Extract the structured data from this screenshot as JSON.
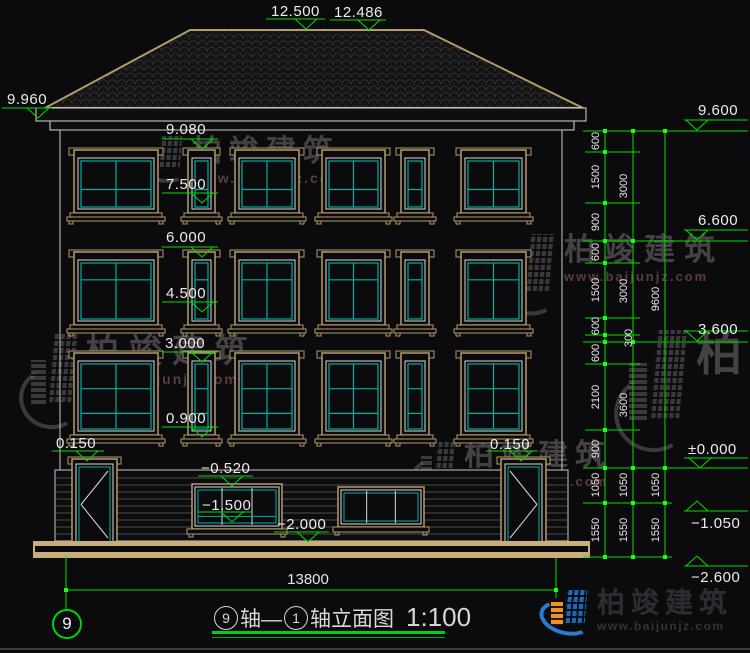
{
  "title_block": {
    "from_axis": "9",
    "mid_text": "轴—",
    "to_axis": "1",
    "suffix_text": "轴立面图",
    "scale": "1:100"
  },
  "axis_marker": "9",
  "bottom_dim": {
    "value": "13800"
  },
  "watermark_text": {
    "name": "柏竣建筑",
    "url": "www.baijunjz.com"
  },
  "logo": {
    "name": "柏竣建筑",
    "url": "www.baijunjz.com"
  },
  "colors": {
    "background": "#0b0b0e",
    "green": "#00dc00",
    "bright_green": "#19ff19",
    "tan": "#b49b6b",
    "ground_tan": "#c7ae7b",
    "teal": "#00b0a0",
    "white_line": "#d9d9d9",
    "text": "#ececec",
    "siding": "#4b4b4b",
    "logo_blue": "#1f66b5",
    "logo_orange": "#f0941f"
  },
  "drawing": {
    "roof": {
      "points": "45,108 190,30 424,30 583,108"
    },
    "eave_bands": [
      {
        "x": 36,
        "y": 108,
        "w": 550,
        "h": 13
      },
      {
        "x": 50,
        "y": 121,
        "w": 524,
        "h": 9
      }
    ],
    "wall": {
      "x": 60,
      "y": 130,
      "w": 502,
      "h": 340
    },
    "plinth": {
      "x": 55,
      "y": 470,
      "w": 513,
      "h": 71,
      "siding_start": 478,
      "siding_end": 538,
      "siding_gap": 7
    },
    "ground_bands": [
      {
        "x": 33,
        "y": 541,
        "w": 557,
        "h": 5
      },
      {
        "x": 33,
        "y": 552,
        "w": 557,
        "h": 6
      },
      {
        "x": 33,
        "y": 541,
        "w": 2,
        "h": 17
      },
      {
        "x": 588,
        "y": 541,
        "w": 2,
        "h": 17
      }
    ],
    "windows": [
      {
        "x": 74,
        "y": 150,
        "w": 84,
        "h": 63,
        "type": 1
      },
      {
        "x": 188,
        "y": 150,
        "w": 27,
        "h": 63,
        "type": 1
      },
      {
        "x": 235,
        "y": 150,
        "w": 64,
        "h": 63,
        "type": 1
      },
      {
        "x": 322,
        "y": 150,
        "w": 63,
        "h": 63,
        "type": 1
      },
      {
        "x": 401,
        "y": 150,
        "w": 28,
        "h": 63,
        "type": 1
      },
      {
        "x": 461,
        "y": 150,
        "w": 65,
        "h": 63,
        "type": 1
      },
      {
        "x": 74,
        "y": 252,
        "w": 84,
        "h": 73,
        "type": 2
      },
      {
        "x": 188,
        "y": 252,
        "w": 27,
        "h": 73,
        "type": 2
      },
      {
        "x": 235,
        "y": 252,
        "w": 64,
        "h": 73,
        "type": 2
      },
      {
        "x": 322,
        "y": 252,
        "w": 63,
        "h": 73,
        "type": 2
      },
      {
        "x": 401,
        "y": 252,
        "w": 28,
        "h": 73,
        "type": 2
      },
      {
        "x": 461,
        "y": 252,
        "w": 65,
        "h": 73,
        "type": 2
      },
      {
        "x": 74,
        "y": 353,
        "w": 84,
        "h": 82,
        "type": 3
      },
      {
        "x": 188,
        "y": 353,
        "w": 27,
        "h": 82,
        "type": 3
      },
      {
        "x": 235,
        "y": 353,
        "w": 64,
        "h": 82,
        "type": 3
      },
      {
        "x": 322,
        "y": 353,
        "w": 63,
        "h": 82,
        "type": 3
      },
      {
        "x": 401,
        "y": 353,
        "w": 28,
        "h": 82,
        "type": 3
      },
      {
        "x": 461,
        "y": 353,
        "w": 65,
        "h": 82,
        "type": 3
      }
    ],
    "doors": [
      {
        "x": 72,
        "y": 459,
        "w": 45,
        "h": 83,
        "dir": "left"
      },
      {
        "x": 501,
        "y": 459,
        "w": 45,
        "h": 83,
        "dir": "right"
      }
    ],
    "basement_windows": [
      {
        "x": 192,
        "y": 484,
        "w": 90,
        "h": 45,
        "hline": true
      },
      {
        "x": 338,
        "y": 487,
        "w": 86,
        "h": 40,
        "hline": false
      }
    ],
    "markers": [
      {
        "t": "12.500",
        "tx": 271,
        "ty": 3,
        "lx1": 266,
        "lx2": 325,
        "ly": 19,
        "tcx": 306,
        "dir": "down"
      },
      {
        "t": "12.486",
        "tx": 334,
        "ty": 4,
        "lx1": 330,
        "lx2": 386,
        "ly": 20,
        "tcx": 369,
        "dir": "down"
      },
      {
        "t": "9.960",
        "tx": 7,
        "ty": 91,
        "lx1": 2,
        "lx2": 52,
        "ly": 108,
        "tcx": 38,
        "dir": "down"
      },
      {
        "t": "9.080",
        "tx": 166,
        "ty": 121,
        "lx1": 162,
        "lx2": 218,
        "ly": 139,
        "tcx": 202,
        "dir": "down"
      },
      {
        "t": "7.500",
        "tx": 166,
        "ty": 176,
        "lx1": 162,
        "lx2": 218,
        "ly": 193,
        "tcx": 202,
        "dir": "down"
      },
      {
        "t": "6.000",
        "tx": 166,
        "ty": 229,
        "lx1": 162,
        "lx2": 218,
        "ly": 247,
        "tcx": 202,
        "dir": "down"
      },
      {
        "t": "4.500",
        "tx": 166,
        "ty": 285,
        "lx1": 162,
        "lx2": 218,
        "ly": 302,
        "tcx": 202,
        "dir": "down"
      },
      {
        "t": "3.000",
        "tx": 165,
        "ty": 335,
        "lx1": 162,
        "lx2": 218,
        "ly": 352,
        "tcx": 202,
        "dir": "down"
      },
      {
        "t": "0.900",
        "tx": 166,
        "ty": 410,
        "lx1": 162,
        "lx2": 218,
        "ly": 427,
        "tcx": 202,
        "dir": "down"
      },
      {
        "t": "0.150",
        "tx": 56,
        "ty": 435,
        "lx1": 52,
        "lx2": 104,
        "ly": 451,
        "tcx": 87,
        "dir": "down"
      },
      {
        "t": "0.150",
        "tx": 490,
        "ty": 436,
        "lx1": 486,
        "lx2": 538,
        "ly": 451,
        "tcx": 521,
        "dir": "down"
      },
      {
        "t": "−0.520",
        "tx": 201,
        "ty": 460,
        "lx1": 198,
        "lx2": 253,
        "ly": 476,
        "tcx": 232,
        "dir": "down"
      },
      {
        "t": "−1.500",
        "tx": 202,
        "ty": 497,
        "lx1": 198,
        "lx2": 253,
        "ly": 512,
        "tcx": 232,
        "dir": "down"
      },
      {
        "t": "−2.000",
        "tx": 277,
        "ty": 516,
        "lx1": 274,
        "lx2": 329,
        "ly": 532,
        "tcx": 308,
        "dir": "down"
      },
      {
        "t": "9.600",
        "tx": 698,
        "ty": 102,
        "lx1": 684,
        "lx2": 748,
        "ly": 120,
        "tcx": 697,
        "dir": "down"
      },
      {
        "t": "6.600",
        "tx": 698,
        "ty": 212,
        "lx1": 684,
        "lx2": 748,
        "ly": 230,
        "tcx": 697,
        "dir": "down"
      },
      {
        "t": "3.600",
        "tx": 698,
        "ty": 321,
        "lx1": 684,
        "lx2": 748,
        "ly": 331,
        "tcx": 697,
        "dir": "down"
      },
      {
        "t": "±0.000",
        "tx": 688,
        "ty": 441,
        "lx1": 684,
        "lx2": 748,
        "ly": 458,
        "tcx": 700,
        "dir": "down"
      },
      {
        "t": "−1.050",
        "tx": 691,
        "ty": 515,
        "lx1": 684,
        "lx2": 748,
        "ly": 511,
        "tcx": 697,
        "dir": "up"
      },
      {
        "t": "−2.600",
        "tx": 691,
        "ty": 569,
        "lx1": 684,
        "lx2": 748,
        "ly": 566,
        "tcx": 697,
        "dir": "up"
      }
    ],
    "chains": {
      "columns": [
        {
          "x": 605,
          "y1": 131,
          "y2": 557,
          "ticks": [
            131,
            152,
            203,
            241,
            263,
            318,
            335,
            342,
            364,
            430,
            468,
            503,
            557
          ]
        },
        {
          "x": 633,
          "y1": 131,
          "y2": 557,
          "ticks": [
            131,
            241,
            342,
            468,
            503,
            557
          ]
        },
        {
          "x": 665,
          "y1": 131,
          "y2": 557,
          "ticks": [
            131,
            468,
            503,
            557
          ]
        }
      ],
      "ext_major": [
        {
          "y": 131
        },
        {
          "y": 241
        },
        {
          "y": 342
        },
        {
          "y": 468
        }
      ],
      "ext_minor": [
        {
          "y": 152
        },
        {
          "y": 203
        },
        {
          "y": 263
        },
        {
          "y": 318
        },
        {
          "y": 335
        },
        {
          "y": 364
        },
        {
          "y": 430
        }
      ],
      "ext_mid": [
        {
          "y": 503
        },
        {
          "y": 557
        }
      ],
      "labels": [
        {
          "v": "600",
          "x": 596,
          "y": 141
        },
        {
          "v": "1500",
          "x": 596,
          "y": 177
        },
        {
          "v": "900",
          "x": 596,
          "y": 222
        },
        {
          "v": "600",
          "x": 596,
          "y": 252
        },
        {
          "v": "1500",
          "x": 596,
          "y": 290
        },
        {
          "v": "600",
          "x": 596,
          "y": 326
        },
        {
          "v": "600",
          "x": 596,
          "y": 353
        },
        {
          "v": "2100",
          "x": 596,
          "y": 397
        },
        {
          "v": "900",
          "x": 596,
          "y": 449
        },
        {
          "v": "1050",
          "x": 596,
          "y": 485
        },
        {
          "v": "1550",
          "x": 596,
          "y": 530
        },
        {
          "v": "3000",
          "x": 624,
          "y": 186
        },
        {
          "v": "3000",
          "x": 624,
          "y": 291
        },
        {
          "v": "300",
          "x": 629,
          "y": 338
        },
        {
          "v": "3600",
          "x": 624,
          "y": 405
        },
        {
          "v": "1050",
          "x": 624,
          "y": 485
        },
        {
          "v": "1550",
          "x": 624,
          "y": 530
        },
        {
          "v": "9600",
          "x": 656,
          "y": 299
        },
        {
          "v": "1050",
          "x": 656,
          "y": 485
        },
        {
          "v": "1550",
          "x": 656,
          "y": 530
        }
      ]
    },
    "bottom_dimension": {
      "line": {
        "x1": 66,
        "x2": 556,
        "y": 590
      },
      "ext1": {
        "x": 66,
        "y1": 556,
        "y2": 609
      },
      "ext2": {
        "x": 556,
        "y1": 558,
        "y2": 598
      },
      "label_x": 308,
      "label_y": 571
    }
  },
  "watermarks": [
    {
      "x": 134,
      "y": 136,
      "iw": 50,
      "ih": 44,
      "fs": 30,
      "ls": 7,
      "ufs": 14,
      "show_url": true
    },
    {
      "x": 22,
      "y": 334,
      "iw": 56,
      "ih": 92,
      "fs": 33,
      "ls": 10,
      "ufs": 14,
      "show_url": true
    },
    {
      "x": 498,
      "y": 234,
      "iw": 58,
      "ih": 78,
      "fs": 31,
      "ls": 9,
      "ufs": 13,
      "show_url": true
    },
    {
      "x": 414,
      "y": 440,
      "iw": 42,
      "ih": 58,
      "fs": 30,
      "ls": 7,
      "ufs": 13,
      "show_url": true
    },
    {
      "x": 618,
      "y": 330,
      "iw": 70,
      "ih": 118,
      "fs": 46,
      "ls": 10,
      "ufs": 15,
      "show_url": false
    }
  ]
}
